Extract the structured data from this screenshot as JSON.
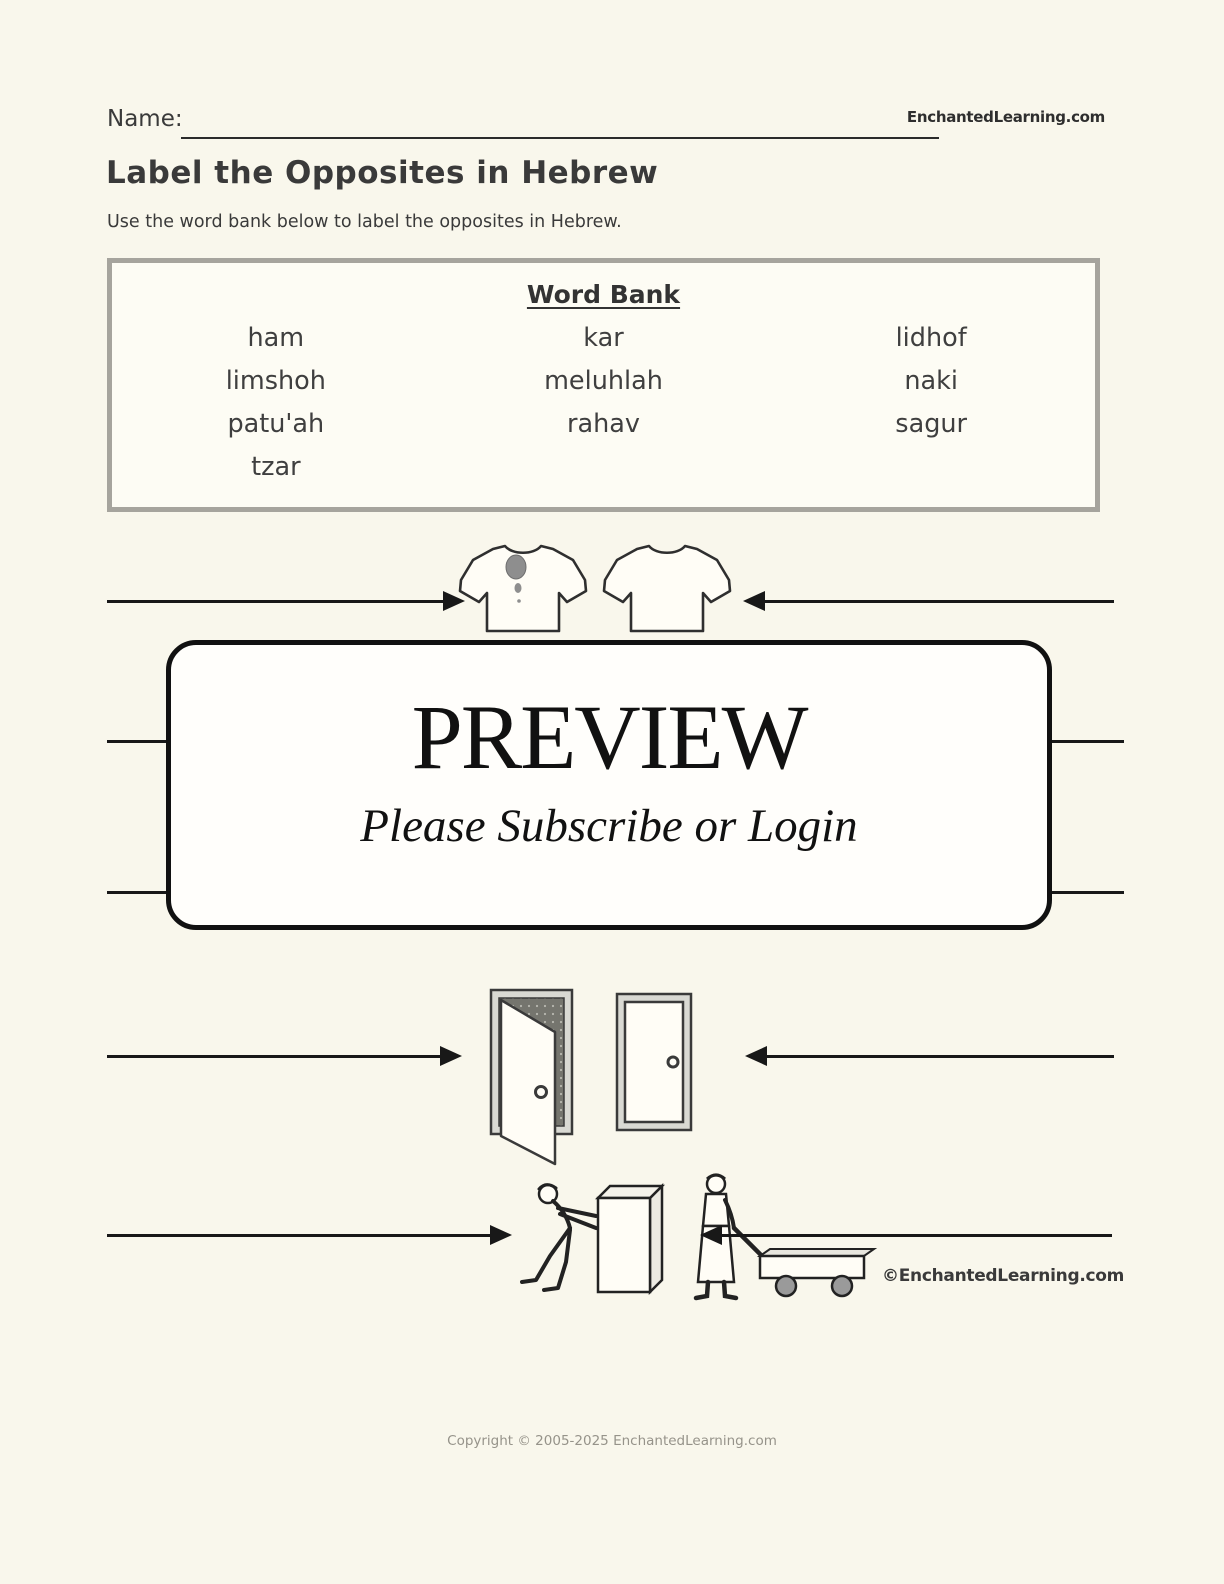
{
  "header": {
    "name_label": "Name:",
    "site_name": "EnchantedLearning.com",
    "title": "Label the Opposites in Hebrew",
    "instructions": "Use the word bank below to label the opposites in Hebrew."
  },
  "word_bank": {
    "title": "Word Bank",
    "words": [
      [
        "ham",
        "kar",
        "lidhof"
      ],
      [
        "limshoh",
        "meluhlah",
        "naki"
      ],
      [
        "patu'ah",
        "rahav",
        "sagur"
      ],
      [
        "tzar",
        "",
        ""
      ]
    ]
  },
  "preview": {
    "title": "PREVIEW",
    "subtitle": "Please Subscribe or Login"
  },
  "illustrations": {
    "row1": "dirty shirt vs clean shirt",
    "row2": "open door vs closed door",
    "row3": "push vs pull",
    "credit": "©EnchantedLearning.com"
  },
  "footer": {
    "copyright": "Copyright © 2005-2025 EnchantedLearning.com"
  },
  "colors": {
    "page_bg": "#f9f7ec",
    "ink": "#3c3c3c",
    "line": "#181818",
    "word_bank_border": "#a6a49d",
    "stain_gray": "#8e8e8e"
  }
}
